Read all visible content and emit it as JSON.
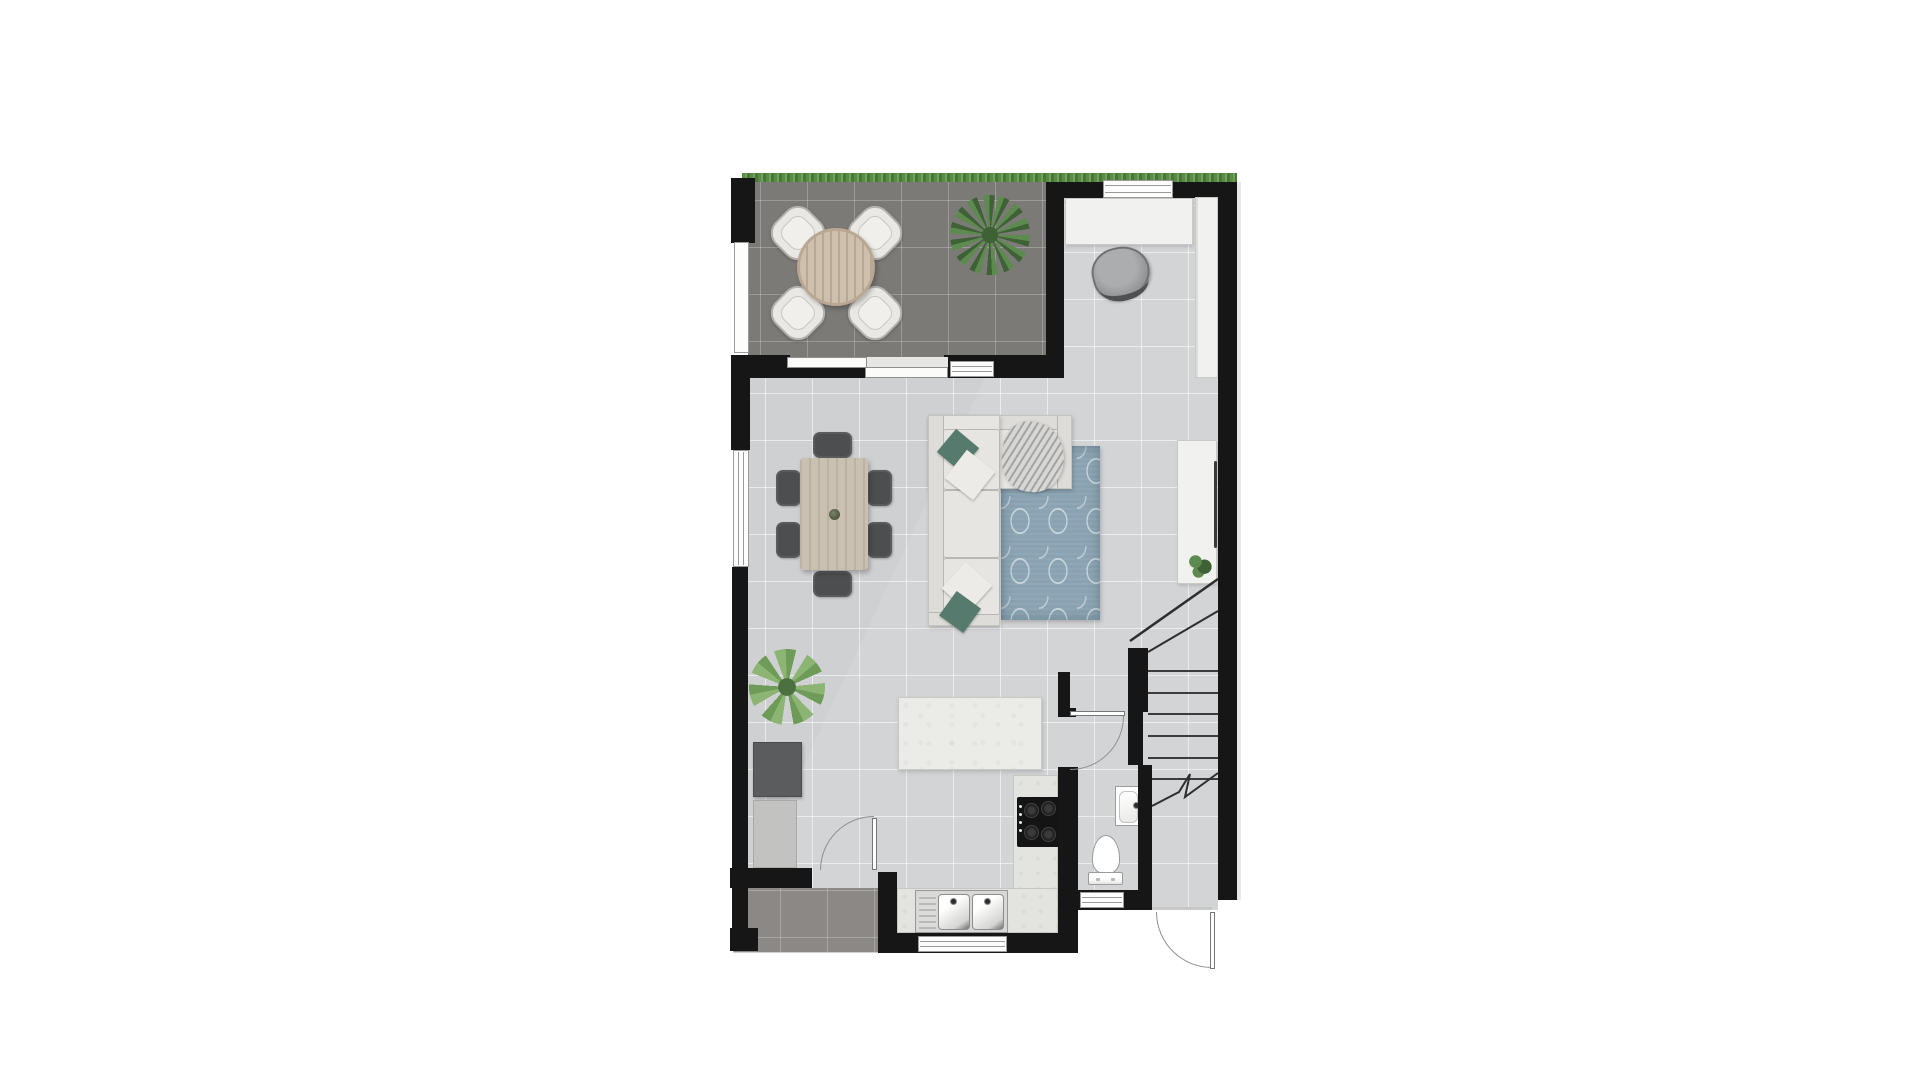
{
  "document": {
    "kind": "architectural floor plan, ground floor, top-down render",
    "visible_text": "none"
  },
  "palette": {
    "wall": "#161616",
    "floor": "#d3d4d6",
    "floor_line": "#ffffff8c",
    "terrace": "#7c7a77",
    "terrace_line": "#ffffff3d",
    "patio": "#8b8886",
    "grass_a": "#5a8b45",
    "grass_b": "#6fa258",
    "grass_c": "#49773a",
    "wood": "#cfc0ae",
    "wood_dark": "#b6a895",
    "table_wood": "#c9c0b2",
    "chair_dark": "#4c4e50",
    "chair_light": "#e9e8e4",
    "chair_border": "#b3b1ac",
    "sofa": "#e6e5e2",
    "sofa_line": "#b9b7b2",
    "pillow_green": "#567a6d",
    "pillow_white": "#edebe7",
    "rug": "#8aa2b1",
    "rug_light": "#c6d4dc",
    "cabinet_white": "#f1f1ef",
    "cabinet_border": "#c9c9c6",
    "island": "#ebebe8",
    "counter": "#e3e3e0",
    "appliance_dark": "#5a5c5e",
    "counter_gray": "#c2c3c1",
    "cooktop": "#141414",
    "fixture": "#ffffff",
    "fixture_border": "#9b9b99",
    "stair_line": "#3c3c3c",
    "door_line": "#8f8f8d",
    "window_frame": "#9a9a98",
    "blanket": "#d7d7d4",
    "blanket_line": "#a3a4a6",
    "office_chair": "#8e9092",
    "office_chair_dark": "#4e5052",
    "plant_dark_a": "#3f6136",
    "plant_dark_b": "#5d8a4e",
    "plant_light_a": "#6e9c58",
    "plant_light_b": "#8cb573"
  },
  "scene": {
    "outdoor": {
      "garden_strip": "grass along full top edge",
      "terrace": [
        "round wooden table",
        "four outdoor chairs",
        "large potted plant"
      ],
      "patio_bottom_left": [
        "dark floor tiles"
      ]
    },
    "living_dining_room": [
      "dining table",
      "six dark chairs",
      "corner sofa",
      "green and white pillows",
      "throw blanket",
      "blue patterned rug",
      "sideboard with handle",
      "small plant on sideboard",
      "tall window left",
      "sliding door to terrace"
    ],
    "entry_nook": [
      "wardrobe closet",
      "tall cabinet",
      "office chair",
      "top window"
    ],
    "kitchen": [
      "island counter",
      "L-shaped counter",
      "gas cooktop",
      "double sink",
      "window above sink",
      "dark cabinet",
      "low cabinet",
      "large potted plant",
      "door to patio"
    ],
    "wc": [
      "washbasin",
      "toilet",
      "window",
      "door"
    ],
    "staircase": [
      "six treads",
      "railing",
      "newel post",
      "break line",
      "front entry door"
    ]
  }
}
